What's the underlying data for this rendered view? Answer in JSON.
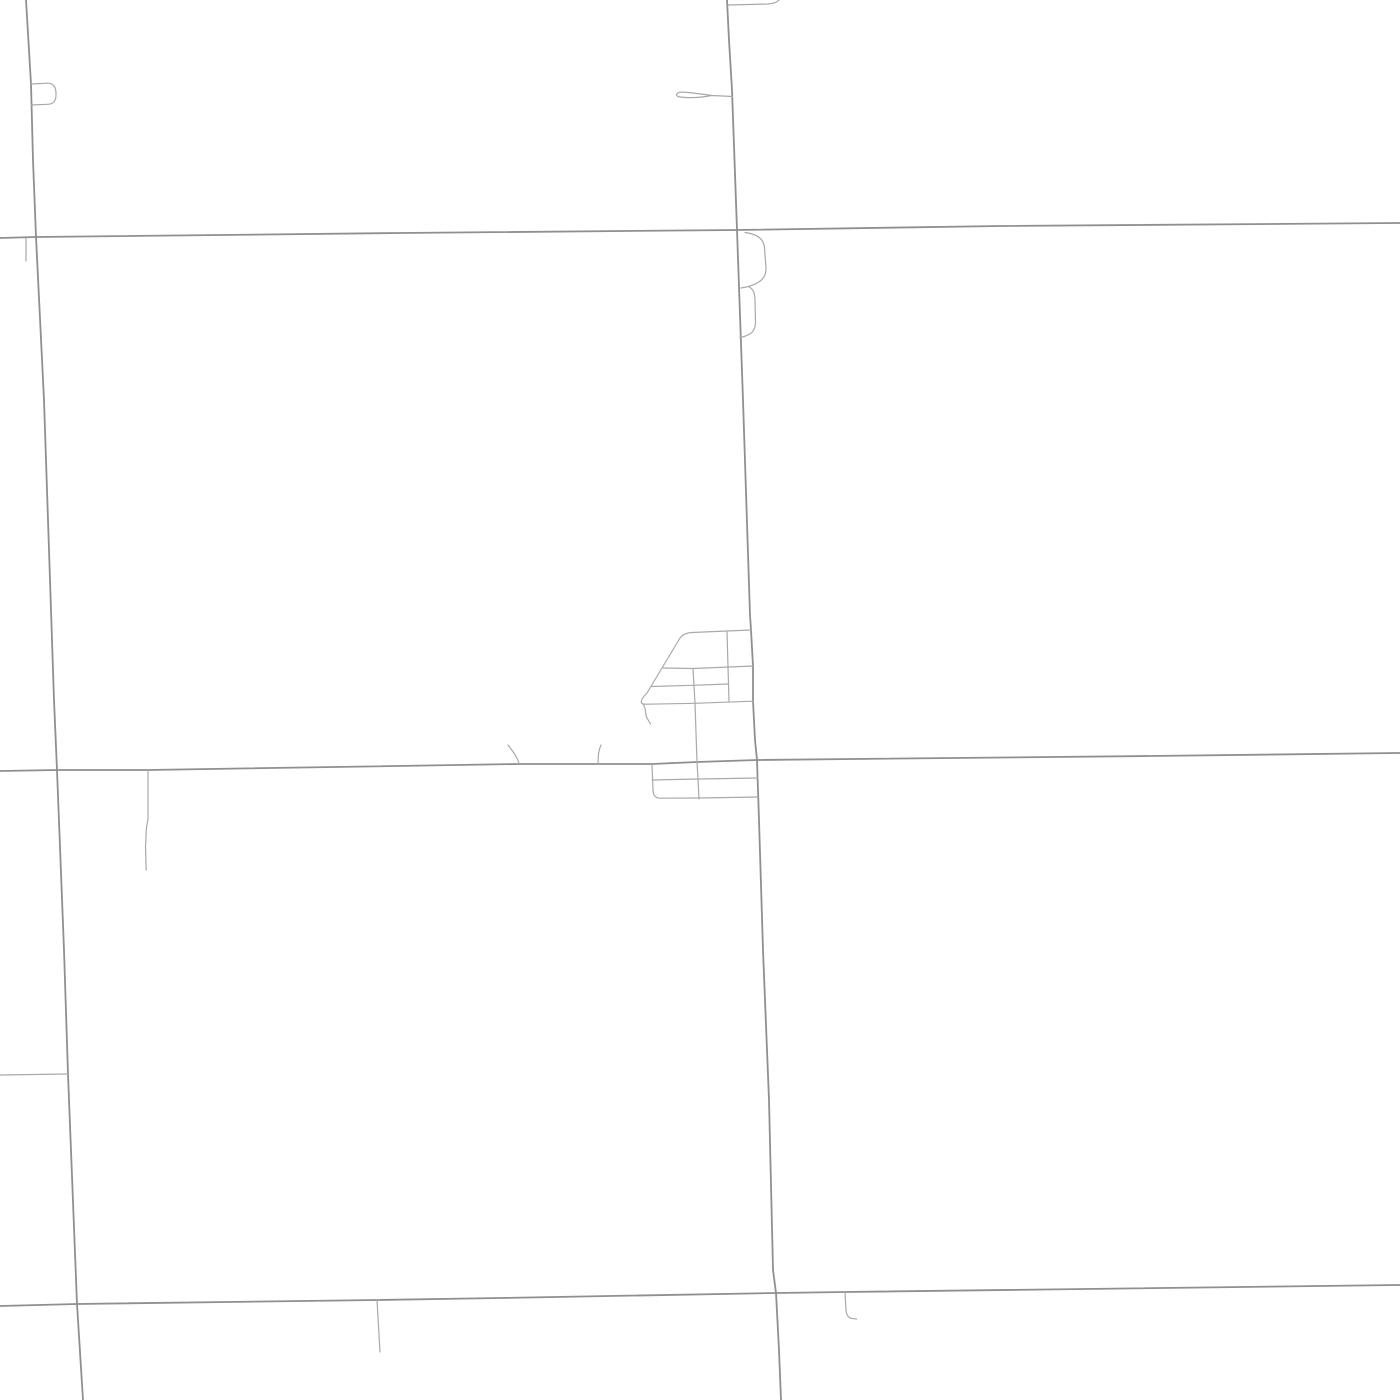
{
  "map": {
    "canvas": {
      "width": 1400,
      "height": 1400,
      "background_color": "#ffffff"
    },
    "styles": {
      "major": {
        "color": "#8f8f8f",
        "width": 1.8
      },
      "minor": {
        "color": "#a9a9a9",
        "width": 1.2
      }
    },
    "roads": [
      {
        "name": "main-vertical-road",
        "class": "major",
        "d": "M727,0 L729,40 L732,90 L737,230 L743,400 L750,615 L751,630 L753,666 L753,701 L755,740 L757,760 L759,820 L763,950 L769,1100 L773,1270 L776,1293 L779,1350 L781,1400"
      },
      {
        "name": "west-vertical-road",
        "class": "major",
        "d": "M26,0 L31,84 L33,160 L36,237 L44,400 L54,700 L57,770 L64,950 L68,1074 L77,1304 L83,1400"
      },
      {
        "name": "north-horizontal-road",
        "class": "major",
        "d": "M0,238 L36,237 L400,233 L737,230 L1000,226 L1400,223"
      },
      {
        "name": "middle-horizontal-road",
        "class": "major",
        "d": "M0,771 L57,770 L148,770 L519,764 L598,764 L652,764 L697,762 L757,760 L1150,756 L1400,753"
      },
      {
        "name": "south-horizontal-road",
        "class": "major",
        "d": "M0,1306 L77,1304 L377,1300 L500,1298 L776,1293 L845,1292 L1400,1285"
      },
      {
        "name": "west-loop-spur",
        "class": "minor",
        "d": "M31,84 L47,83.2 Q56,83 56,93.5 Q56.5,104 48,104.3 L31,105"
      },
      {
        "name": "west-deadend-spur-north",
        "class": "minor",
        "d": "M26,238.5 L26,261"
      },
      {
        "name": "top-edge-stub",
        "class": "minor",
        "d": "M728,5 L768,4 Q776,3.5 779,0"
      },
      {
        "name": "sliver-loop-spur",
        "class": "minor",
        "d": "M732.5,96.5 L712,95.5 C700,94 684,91.2 679.5,92.3 C675.5,93.4 675.5,96.4 680,97 C692,98.4 705,96.8 712,95.5"
      },
      {
        "name": "east-bump-upper",
        "class": "minor",
        "d": "M745,232.5 C757,234 764,238.5 764.5,248 L766,268 C766.5,278.5 759,283.5 748.5,286.5 L741,288"
      },
      {
        "name": "east-bump-lower",
        "class": "minor",
        "d": "M748.5,286.5 C753.5,289 755,293.5 755,301 L755.5,322 C755.5,331 751,334.5 744,336.5 L740,337.5"
      },
      {
        "name": "town-north-block-outline",
        "class": "minor",
        "d": "M751,630 L692,632.5 Q683.5,633 680,638 L647,693 Q641.5,698.5 641.2,701.5 Q641.2,704.5 647,704.2 L695,703.3 L753,701.2"
      },
      {
        "name": "town-mid-street-upper",
        "class": "minor",
        "d": "M663,668 L693,668.5 L753,666"
      },
      {
        "name": "town-mid-street-lower",
        "class": "minor",
        "d": "M652,686.5 L693,685.3 L728,684"
      },
      {
        "name": "town-cross-street-a",
        "class": "minor",
        "d": "M693,668.5 L695,703.3 L697,762 L698,779 L699,799"
      },
      {
        "name": "town-cross-street-b",
        "class": "minor",
        "d": "M727,632 L728,666.5 L729,701.2"
      },
      {
        "name": "town-corner-tail",
        "class": "minor",
        "d": "M643,704.5 C647,709 644.5,714 647,718 L650.5,724"
      },
      {
        "name": "town-south-block-outline",
        "class": "minor",
        "d": "M652,764.5 L653,790 Q653.5,798.3 660,798.2 L699,798 L758,797"
      },
      {
        "name": "town-south-block-mid-street",
        "class": "minor",
        "d": "M652,780 L699,779 L758,778"
      },
      {
        "name": "field-access-tick-west",
        "class": "minor",
        "d": "M508,745 C512,750.5 517,756 519,763.5"
      },
      {
        "name": "field-access-tick-east",
        "class": "minor",
        "d": "M601,745 C598.5,750.5 597.8,757 598.2,764"
      },
      {
        "name": "middle-road-deadend-spur",
        "class": "minor",
        "d": "M148,770 L148,820 C145,830 146.5,838 145.5,846 L146.2,870"
      },
      {
        "name": "west-edge-stub",
        "class": "minor",
        "d": "M0,1075 L68,1074"
      },
      {
        "name": "south-road-deadend-spur",
        "class": "minor",
        "d": "M377,1300 L380,1352"
      },
      {
        "name": "south-road-hook-spur",
        "class": "minor",
        "d": "M845,1292.5 L846,1310 Q846.5,1318.5 854,1318.7 L856.5,1319"
      }
    ]
  }
}
